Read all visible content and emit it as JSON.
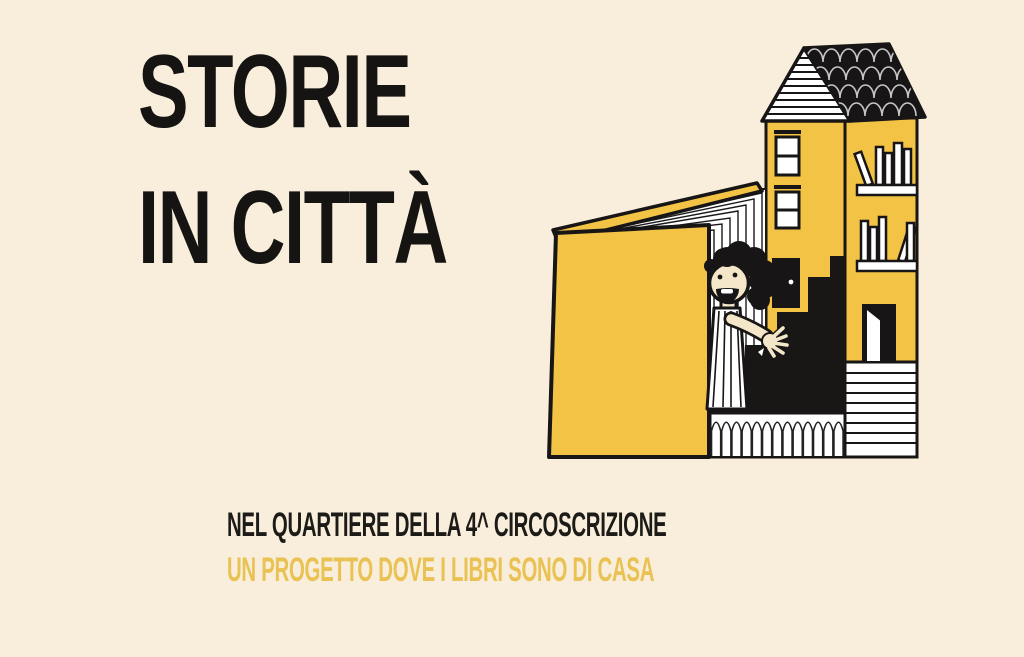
{
  "poster": {
    "title_line1": "STORIE",
    "title_line2": "IN CITTÀ",
    "subtitle_black": "NEL QUARTIERE DELLA 4^ CIRCOSCRIZIONE",
    "subtitle_yellow": "UN PROGETTO DOVE I LIBRI SONO DI CASA"
  },
  "colors": {
    "background": "#f8eedb",
    "illustration_yellow": "#f2c344",
    "ink_black": "#171515",
    "subtitle_accent": "#eac253",
    "skin": "#f4e7c9",
    "roof_tile_stroke": "#c7c7c7"
  },
  "illustration": {
    "name": "open-book-house",
    "elements": [
      "striped-gable-roof",
      "black-scalloped-roof",
      "yellow-tower-with-windows",
      "black-door-with-knob",
      "bookshelves-with-books",
      "small-open-white-door",
      "striped-base-block",
      "black-staircase",
      "arched-colonnade",
      "open-yellow-book-with-fanned-pages",
      "waving-child-character"
    ]
  }
}
